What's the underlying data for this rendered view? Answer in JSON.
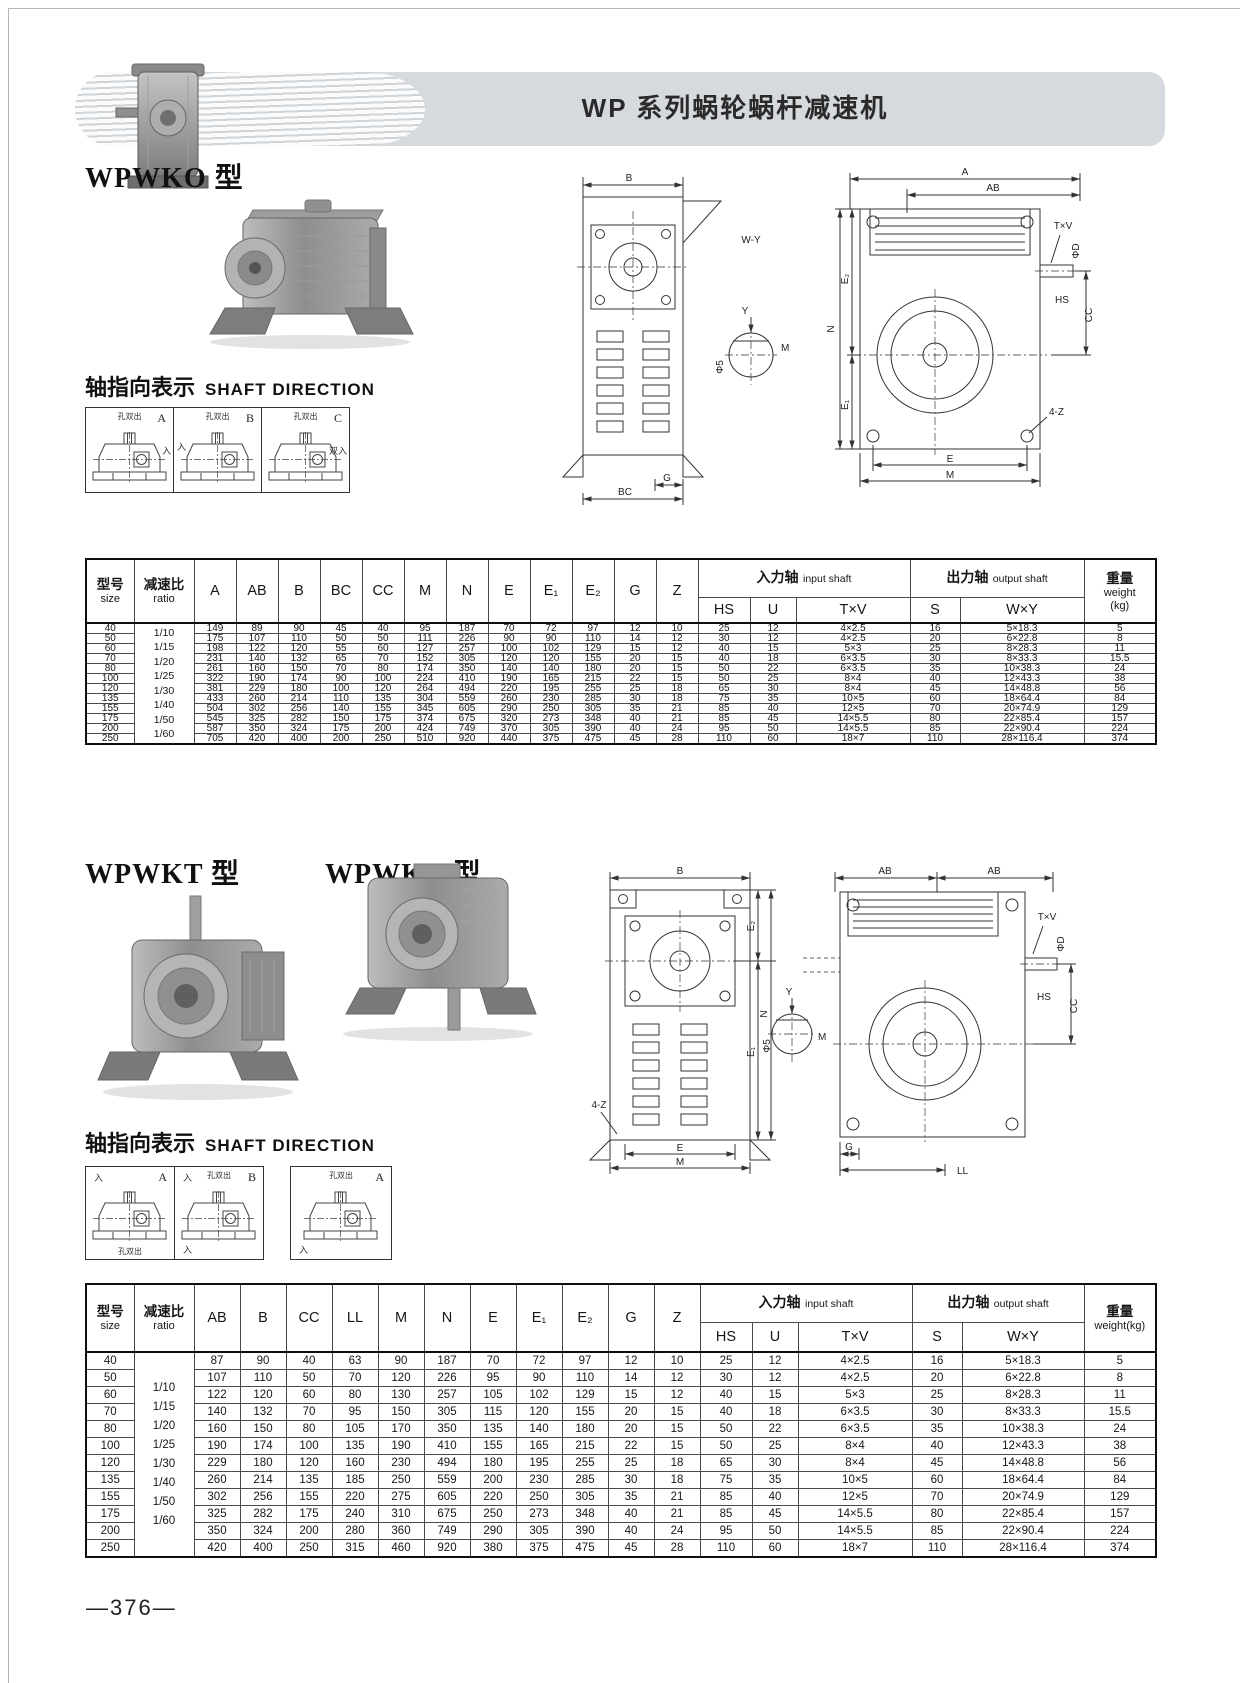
{
  "page": {
    "title": "WP 系列蜗轮蜗杆减速机",
    "page_number": "—376—"
  },
  "sections": {
    "wpwko": {
      "heading": "WPWKO 型",
      "shaft_zh": "轴指向表示",
      "shaft_en": "SHAFT DIRECTION",
      "direction_boxes": [
        {
          "letter": "A",
          "top_label": "孔双出",
          "side_label": "入"
        },
        {
          "letter": "B",
          "top_label": "孔双出",
          "side_label": "入"
        },
        {
          "letter": "C",
          "top_label": "孔双出",
          "side_label": "双入"
        }
      ]
    },
    "wpwkt_v": {
      "heading": "WPWKT 型",
      "heading2": "WPWKV 型",
      "shaft_zh": "轴指向表示",
      "shaft_en": "SHAFT DIRECTION",
      "direction_boxes": [
        {
          "letter": "A",
          "top_label": "",
          "tl_label": "入",
          "bottom_label": "孔双出"
        },
        {
          "letter": "B",
          "top_label": "孔双出",
          "tl_label": "入",
          "bottom_label": "入"
        },
        {
          "letter": "A",
          "top_label": "孔双出",
          "tl_label": "",
          "bottom_label": "入"
        }
      ]
    }
  },
  "drawing1": {
    "front_top": "B",
    "front_g": "G",
    "front_bc": "BC",
    "mid_wy": "W-Y",
    "mid_y": "Y",
    "mid_m": "M",
    "mid_phi": "Φ5",
    "top_a": "A",
    "top_ab": "AB",
    "v_n": "N",
    "v_e2": "E₂",
    "v_e1": "E₁",
    "tv": "T×V",
    "phid": "ΦD",
    "hs": "HS",
    "cc": "CC",
    "z4": "4-Z",
    "bottom_e": "E",
    "bottom_m": "M"
  },
  "drawing2": {
    "front_top": "B",
    "z4": "4-Z",
    "v_n": "N",
    "v_e2": "E₂",
    "v_e1": "E₁",
    "bottom_e": "E",
    "bottom_m": "M",
    "mid_y": "Y",
    "mid_m": "M",
    "mid_phi": "Φ5",
    "top_ab1": "AB",
    "top_ab2": "AB",
    "tv": "T×V",
    "phid": "ΦD",
    "hs": "HS",
    "cc": "CC",
    "bottom_g": "G",
    "bottom_ll": "LL"
  },
  "table1": {
    "col_headers": {
      "size_zh": "型号",
      "size_en": "size",
      "ratio_zh": "减速比",
      "ratio_en": "ratio",
      "input_zh": "入力轴",
      "input_en": "input shaft",
      "output_zh": "出力轴",
      "output_en": "output shaft",
      "weight_zh": "重量",
      "weight_en": "weight",
      "weight_unit": "(kg)"
    },
    "dim_cols": [
      "A",
      "AB",
      "B",
      "BC",
      "CC",
      "M",
      "N",
      "E",
      "E₁",
      "E₂",
      "G",
      "Z"
    ],
    "shaft_cols": [
      "HS",
      "U",
      "T×V",
      "S",
      "W×Y"
    ],
    "ratios": [
      "1/10",
      "1/15",
      "1/20",
      "1/25",
      "1/30",
      "1/40",
      "1/50",
      "1/60"
    ],
    "rows": [
      [
        "40",
        "149",
        "89",
        "90",
        "45",
        "40",
        "95",
        "187",
        "70",
        "72",
        "97",
        "12",
        "10",
        "25",
        "12",
        "4×2.5",
        "16",
        "5×18.3",
        "5"
      ],
      [
        "50",
        "175",
        "107",
        "110",
        "50",
        "50",
        "111",
        "226",
        "90",
        "90",
        "110",
        "14",
        "12",
        "30",
        "12",
        "4×2.5",
        "20",
        "6×22.8",
        "8"
      ],
      [
        "60",
        "198",
        "122",
        "120",
        "55",
        "60",
        "127",
        "257",
        "100",
        "102",
        "129",
        "15",
        "12",
        "40",
        "15",
        "5×3",
        "25",
        "8×28.3",
        "11"
      ],
      [
        "70",
        "231",
        "140",
        "132",
        "65",
        "70",
        "152",
        "305",
        "120",
        "120",
        "155",
        "20",
        "15",
        "40",
        "18",
        "6×3.5",
        "30",
        "8×33.3",
        "15.5"
      ],
      [
        "80",
        "261",
        "160",
        "150",
        "70",
        "80",
        "174",
        "350",
        "140",
        "140",
        "180",
        "20",
        "15",
        "50",
        "22",
        "6×3.5",
        "35",
        "10×38.3",
        "24"
      ],
      [
        "100",
        "322",
        "190",
        "174",
        "90",
        "100",
        "224",
        "410",
        "190",
        "165",
        "215",
        "22",
        "15",
        "50",
        "25",
        "8×4",
        "40",
        "12×43.3",
        "38"
      ],
      [
        "120",
        "381",
        "229",
        "180",
        "100",
        "120",
        "264",
        "494",
        "220",
        "195",
        "255",
        "25",
        "18",
        "65",
        "30",
        "8×4",
        "45",
        "14×48.8",
        "56"
      ],
      [
        "135",
        "433",
        "260",
        "214",
        "110",
        "135",
        "304",
        "559",
        "260",
        "230",
        "285",
        "30",
        "18",
        "75",
        "35",
        "10×5",
        "60",
        "18×64.4",
        "84"
      ],
      [
        "155",
        "504",
        "302",
        "256",
        "140",
        "155",
        "345",
        "605",
        "290",
        "250",
        "305",
        "35",
        "21",
        "85",
        "40",
        "12×5",
        "70",
        "20×74.9",
        "129"
      ],
      [
        "175",
        "545",
        "325",
        "282",
        "150",
        "175",
        "374",
        "675",
        "320",
        "273",
        "348",
        "40",
        "21",
        "85",
        "45",
        "14×5.5",
        "80",
        "22×85.4",
        "157"
      ],
      [
        "200",
        "587",
        "350",
        "324",
        "175",
        "200",
        "424",
        "749",
        "370",
        "305",
        "390",
        "40",
        "24",
        "95",
        "50",
        "14×5.5",
        "85",
        "22×90.4",
        "224"
      ],
      [
        "250",
        "705",
        "420",
        "400",
        "200",
        "250",
        "510",
        "920",
        "440",
        "375",
        "475",
        "45",
        "28",
        "110",
        "60",
        "18×7",
        "110",
        "28×116.4",
        "374"
      ]
    ]
  },
  "table2": {
    "col_headers": {
      "size_zh": "型号",
      "size_en": "size",
      "ratio_zh": "减速比",
      "ratio_en": "ratio",
      "input_zh": "入力轴",
      "input_en": "input shaft",
      "output_zh": "出力轴",
      "output_en": "output shaft",
      "weight_zh": "重量",
      "weight_en": "weight(kg)"
    },
    "dim_cols": [
      "AB",
      "B",
      "CC",
      "LL",
      "M",
      "N",
      "E",
      "E₁",
      "E₂",
      "G",
      "Z"
    ],
    "shaft_cols": [
      "HS",
      "U",
      "T×V",
      "S",
      "W×Y"
    ],
    "ratios": [
      "1/10",
      "1/15",
      "1/20",
      "1/25",
      "1/30",
      "1/40",
      "1/50",
      "1/60"
    ],
    "rows": [
      [
        "40",
        "87",
        "90",
        "40",
        "63",
        "90",
        "187",
        "70",
        "72",
        "97",
        "12",
        "10",
        "25",
        "12",
        "4×2.5",
        "16",
        "5×18.3",
        "5"
      ],
      [
        "50",
        "107",
        "110",
        "50",
        "70",
        "120",
        "226",
        "95",
        "90",
        "110",
        "14",
        "12",
        "30",
        "12",
        "4×2.5",
        "20",
        "6×22.8",
        "8"
      ],
      [
        "60",
        "122",
        "120",
        "60",
        "80",
        "130",
        "257",
        "105",
        "102",
        "129",
        "15",
        "12",
        "40",
        "15",
        "5×3",
        "25",
        "8×28.3",
        "11"
      ],
      [
        "70",
        "140",
        "132",
        "70",
        "95",
        "150",
        "305",
        "115",
        "120",
        "155",
        "20",
        "15",
        "40",
        "18",
        "6×3.5",
        "30",
        "8×33.3",
        "15.5"
      ],
      [
        "80",
        "160",
        "150",
        "80",
        "105",
        "170",
        "350",
        "135",
        "140",
        "180",
        "20",
        "15",
        "50",
        "22",
        "6×3.5",
        "35",
        "10×38.3",
        "24"
      ],
      [
        "100",
        "190",
        "174",
        "100",
        "135",
        "190",
        "410",
        "155",
        "165",
        "215",
        "22",
        "15",
        "50",
        "25",
        "8×4",
        "40",
        "12×43.3",
        "38"
      ],
      [
        "120",
        "229",
        "180",
        "120",
        "160",
        "230",
        "494",
        "180",
        "195",
        "255",
        "25",
        "18",
        "65",
        "30",
        "8×4",
        "45",
        "14×48.8",
        "56"
      ],
      [
        "135",
        "260",
        "214",
        "135",
        "185",
        "250",
        "559",
        "200",
        "230",
        "285",
        "30",
        "18",
        "75",
        "35",
        "10×5",
        "60",
        "18×64.4",
        "84"
      ],
      [
        "155",
        "302",
        "256",
        "155",
        "220",
        "275",
        "605",
        "220",
        "250",
        "305",
        "35",
        "21",
        "85",
        "40",
        "12×5",
        "70",
        "20×74.9",
        "129"
      ],
      [
        "175",
        "325",
        "282",
        "175",
        "240",
        "310",
        "675",
        "250",
        "273",
        "348",
        "40",
        "21",
        "85",
        "45",
        "14×5.5",
        "80",
        "22×85.4",
        "157"
      ],
      [
        "200",
        "350",
        "324",
        "200",
        "280",
        "360",
        "749",
        "290",
        "305",
        "390",
        "40",
        "24",
        "95",
        "50",
        "14×5.5",
        "85",
        "22×90.4",
        "224"
      ],
      [
        "250",
        "420",
        "400",
        "250",
        "315",
        "460",
        "920",
        "380",
        "375",
        "475",
        "45",
        "28",
        "110",
        "60",
        "18×7",
        "110",
        "28×116.4",
        "374"
      ]
    ]
  }
}
